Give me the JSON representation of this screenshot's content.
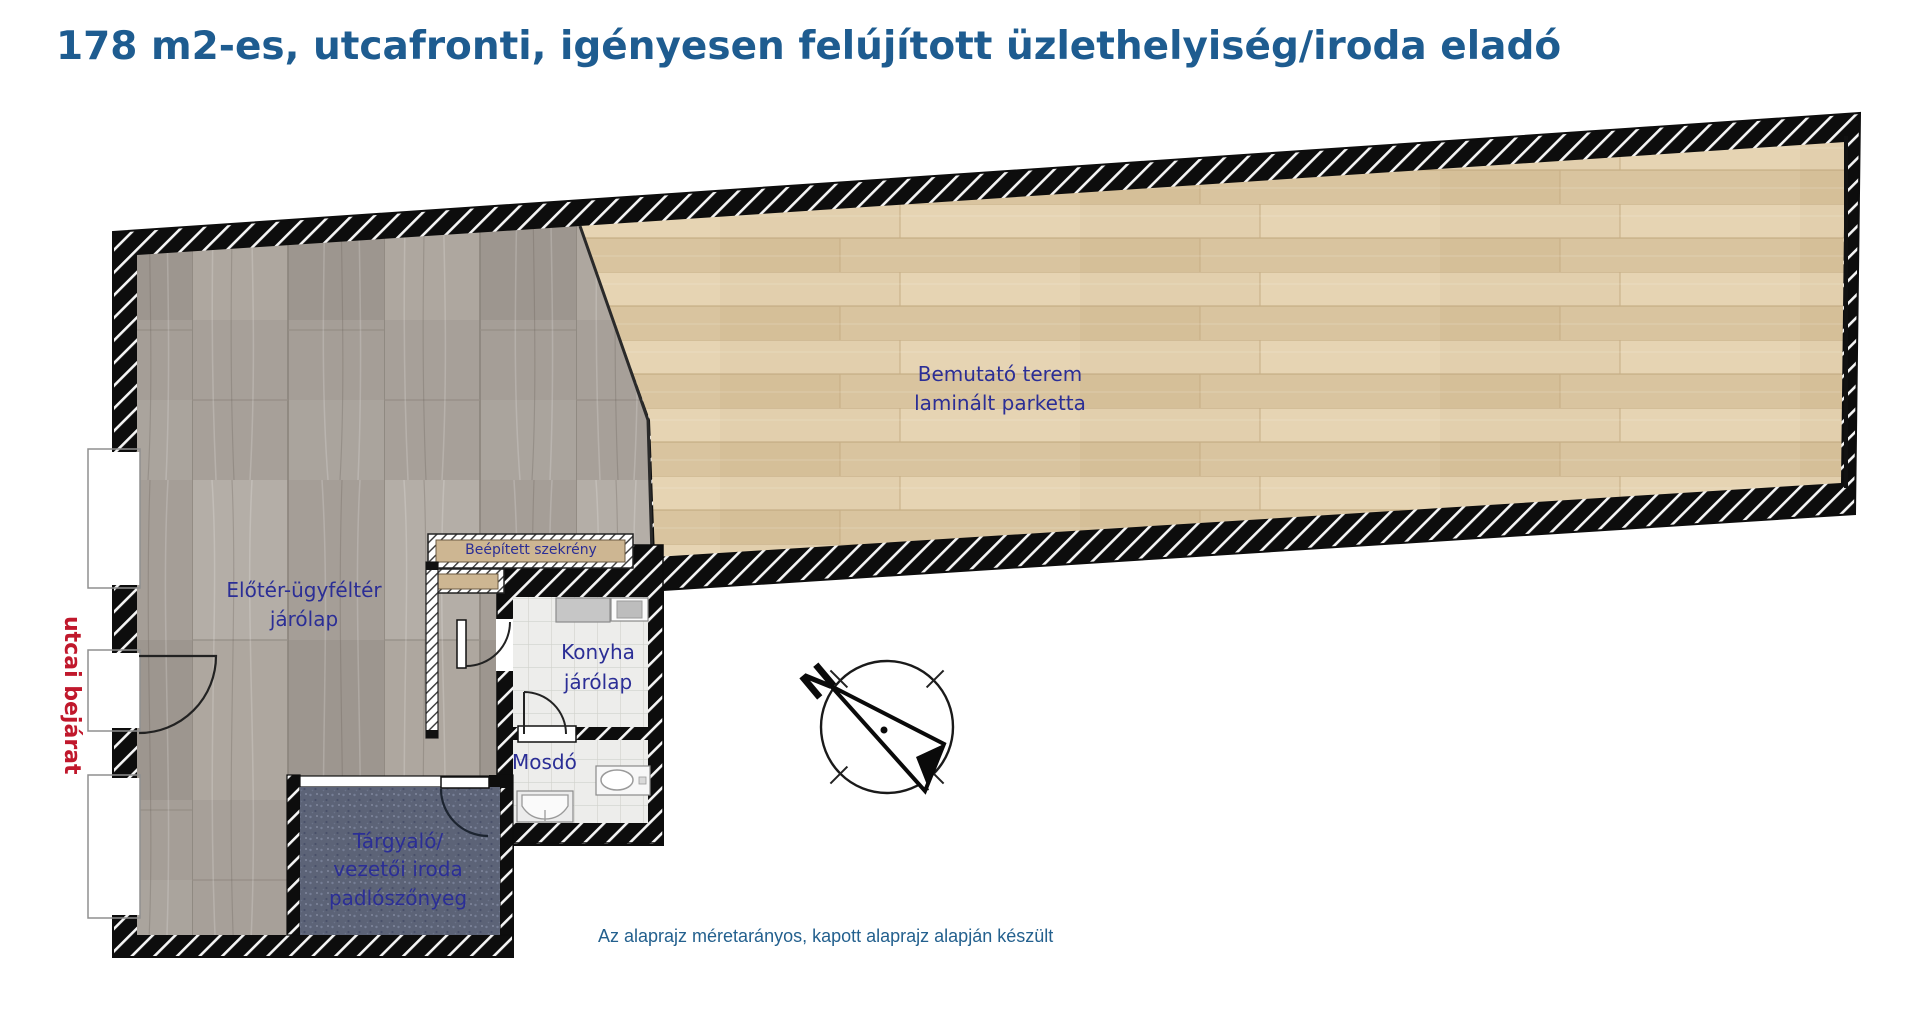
{
  "header": {
    "title": "178 m2-es, utcafronti, igényesen felújított üzlethelyiség/iroda eladó"
  },
  "floor_plan": {
    "rooms": {
      "showroom": {
        "name": "Bemutató terem",
        "floor": "laminált parketta"
      },
      "foyer": {
        "name": "Előtér-ügyféltér",
        "floor": "járólap"
      },
      "kitchen": {
        "name": "Konyha",
        "floor": "járólap"
      },
      "washroom": {
        "name": "Mosdó"
      },
      "meeting_room": {
        "name": "Tárgyaló/",
        "name2": "vezetői iroda",
        "floor": "padlószőnyeg"
      },
      "cabinet": {
        "name": "Beépített szekrény"
      }
    },
    "annotations": {
      "street_entrance": "utcai bejárat",
      "compass_north": "N",
      "scale_note": "Az alaprajz méretarányos, kapott alaprajz alapján készült"
    },
    "colors": {
      "title_blue": "#1e5c90",
      "label_navy": "#2b2e96",
      "entrance_red": "#c0182c",
      "note_blue": "#23608e",
      "showroom_floor": "#e2cfad",
      "foyer_floor": "#aca59e",
      "carpet": "#5c6377",
      "tile": "#ededeb",
      "wall": "#0d0d0d",
      "cabinet_fill": "#cdb692"
    }
  }
}
